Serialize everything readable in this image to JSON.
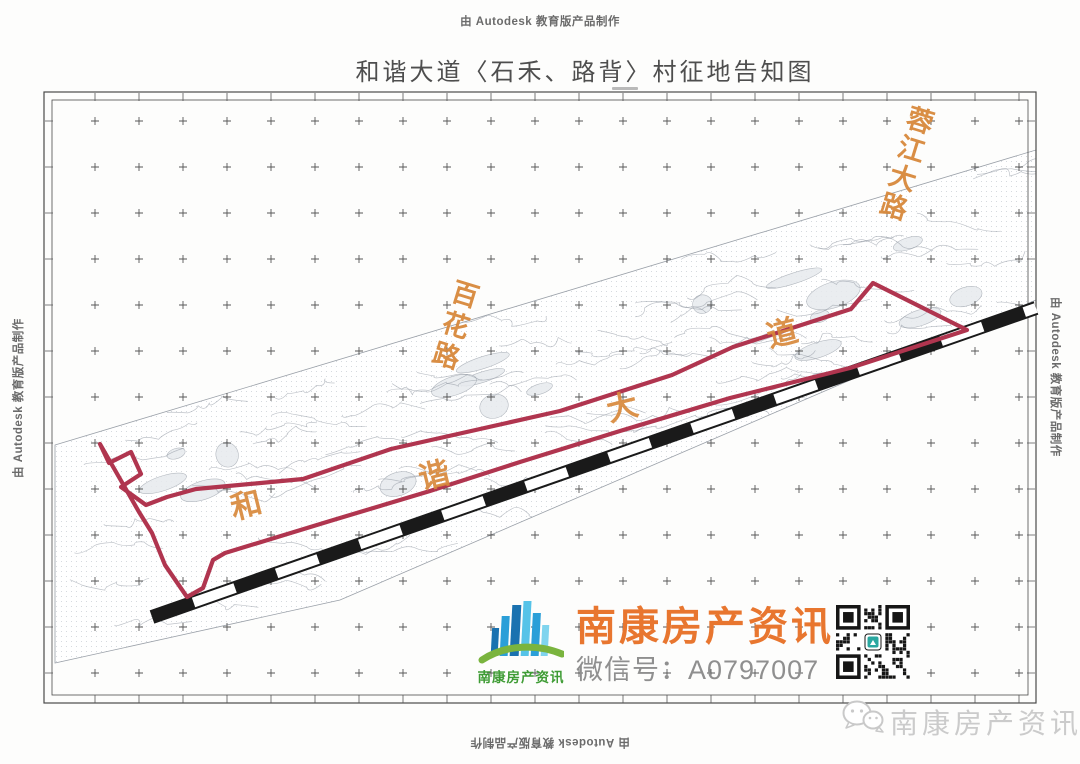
{
  "credits": {
    "top": "由 Autodesk 教育版产品制作",
    "left": "由 Autodesk 教育版产品制作",
    "right": "由 Autodesk 教育版产品制作",
    "bottom": "由 Autodesk 教育版产品制作"
  },
  "title": "和谐大道〈石禾、路背〉村征地告知图",
  "map": {
    "road_labels": [
      {
        "id": "rongjiang",
        "text": "蓉江大路"
      },
      {
        "id": "baihua",
        "text": "百花路"
      }
    ],
    "corridor_label_chars": [
      "和",
      "谐",
      "大",
      "道"
    ],
    "colors": {
      "acquisition_boundary": "#b0354f",
      "road_label": "#d8893c",
      "scale_bar": "#1a1a1a",
      "survey_grid": "#3a3a3a"
    }
  },
  "branding": {
    "logo_caption": "南康房产资讯",
    "brand_name": "南康房产资讯",
    "wechat_line": "微信号：A0797007",
    "watermark_text": "南康房产资讯",
    "colors": {
      "brand_orange": "#e8762f",
      "logo_green": "#3f9c35",
      "wechat_gray": "#8f8f8f",
      "watermark_gray": "#cbcbcb"
    }
  }
}
